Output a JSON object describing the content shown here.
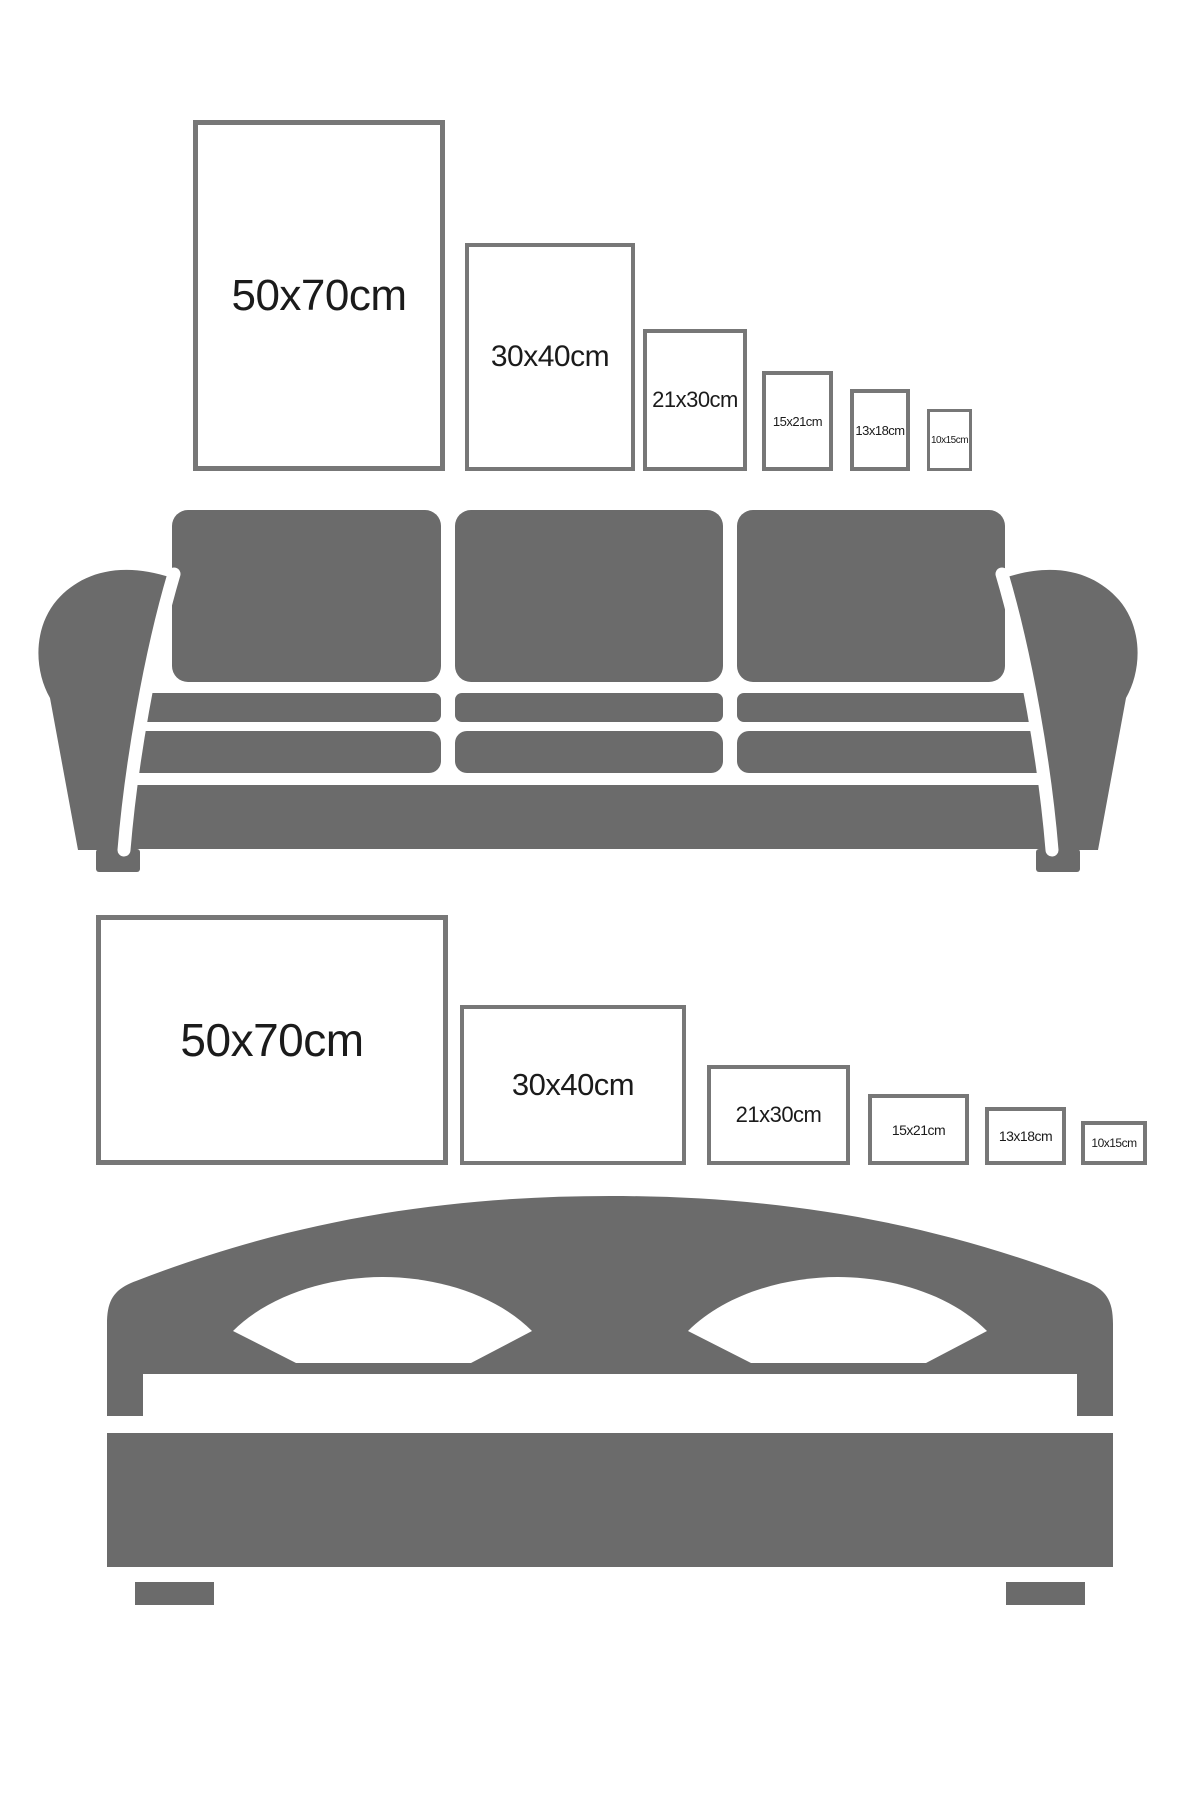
{
  "colors": {
    "background": "#ffffff",
    "furniture_gray": "#6b6b6b",
    "frame_border": "#777777",
    "frame_fill": "#ffffff",
    "label_text": "#1b1b1b"
  },
  "sofa_section": {
    "furniture": "sofa",
    "frame_orientation": "portrait",
    "frames": [
      {
        "label": "50x70cm",
        "width_cm": 50,
        "height_cm": 70
      },
      {
        "label": "30x40cm",
        "width_cm": 30,
        "height_cm": 40
      },
      {
        "label": "21x30cm",
        "width_cm": 21,
        "height_cm": 30
      },
      {
        "label": "15x21cm",
        "width_cm": 15,
        "height_cm": 21
      },
      {
        "label": "13x18cm",
        "width_cm": 13,
        "height_cm": 18
      },
      {
        "label": "10x15cm",
        "width_cm": 10,
        "height_cm": 15
      }
    ]
  },
  "bed_section": {
    "furniture": "bed",
    "frame_orientation": "landscape",
    "frames": [
      {
        "label": "50x70cm",
        "width_cm": 70,
        "height_cm": 50
      },
      {
        "label": "30x40cm",
        "width_cm": 40,
        "height_cm": 30
      },
      {
        "label": "21x30cm",
        "width_cm": 30,
        "height_cm": 21
      },
      {
        "label": "15x21cm",
        "width_cm": 21,
        "height_cm": 15
      },
      {
        "label": "13x18cm",
        "width_cm": 18,
        "height_cm": 13
      },
      {
        "label": "10x15cm",
        "width_cm": 15,
        "height_cm": 10
      }
    ]
  }
}
